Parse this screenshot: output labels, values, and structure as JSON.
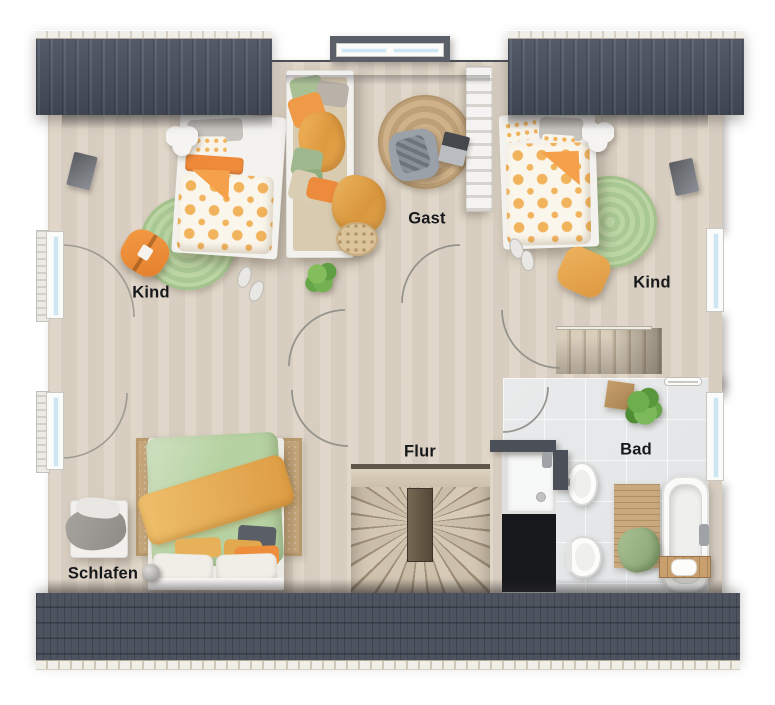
{
  "title": "Obergeschoss Grundriss",
  "rooms": [
    {
      "id": "kind-left",
      "label": "Kind"
    },
    {
      "id": "gast",
      "label": "Gast"
    },
    {
      "id": "kind-right",
      "label": "Kind"
    },
    {
      "id": "schlafen",
      "label": "Schlafen"
    },
    {
      "id": "flur",
      "label": "Flur"
    },
    {
      "id": "bad",
      "label": "Bad"
    }
  ],
  "palette": {
    "wall": "#4b5058",
    "roof": "#4a5260",
    "floor_wood": "#ddd3c5",
    "floor_tile": "#e8eaeb",
    "rug_green": "#b8d2a0",
    "rug_jute": "#c6a77c",
    "accent_orange": "#f0923e",
    "duvet_green": "#b7d2a2",
    "blanket_yellow": "#e2a54e",
    "furniture_white": "#f1f0ed",
    "shaft_black": "#17191c",
    "window_glass": "#cde6f2",
    "stair_wood": "#d3c6b3"
  }
}
